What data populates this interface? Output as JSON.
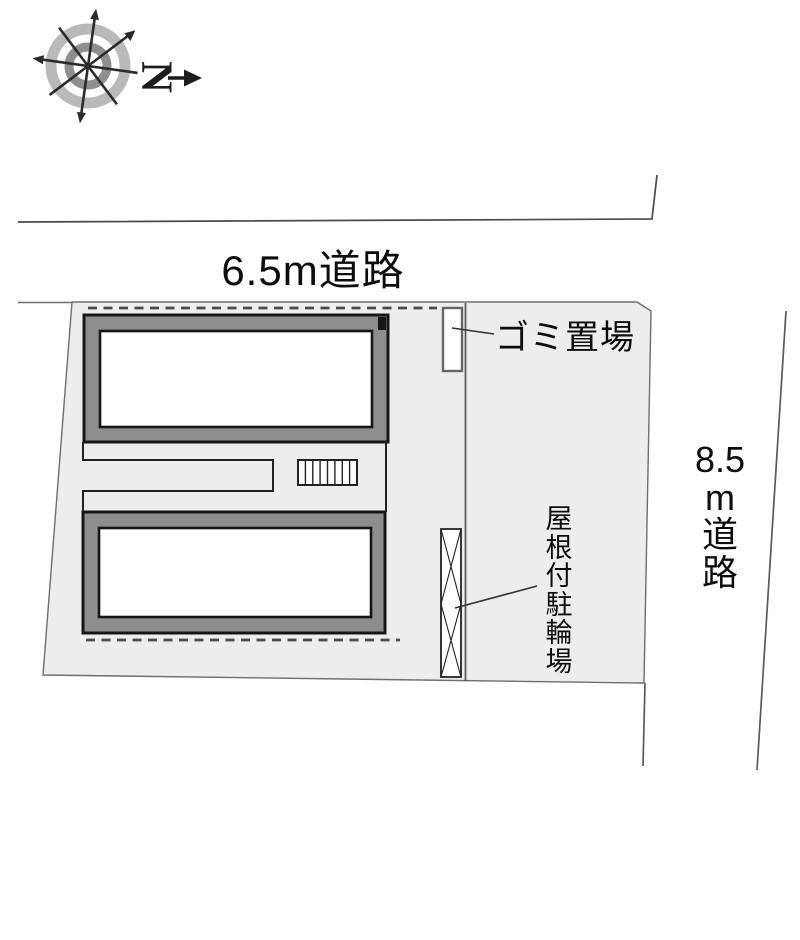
{
  "site_plan": {
    "title": "site layout plan",
    "compass": {
      "north_label": "N"
    },
    "road_top": {
      "label": "6.5m道路"
    },
    "road_right": {
      "label": "8.5m道路",
      "lines": [
        "8.5",
        "m",
        "道",
        "路"
      ]
    },
    "garbage": {
      "label": "ゴミ置場"
    },
    "bicycle_parking": {
      "label": "屋根付駐輪場",
      "lines": [
        "屋",
        "根",
        "付",
        "駐",
        "輪",
        "場"
      ]
    },
    "colors": {
      "plot_fill": "#ededed",
      "building_frame": "#8d8d8d",
      "building_outline": "#161616",
      "boundary_line": "#6e6e6e",
      "thin_line": "#444444",
      "dashed_line": "#4a4a4a",
      "ring_outer": "#b9b9b9",
      "ring_inner": "#8f8f8f"
    }
  }
}
